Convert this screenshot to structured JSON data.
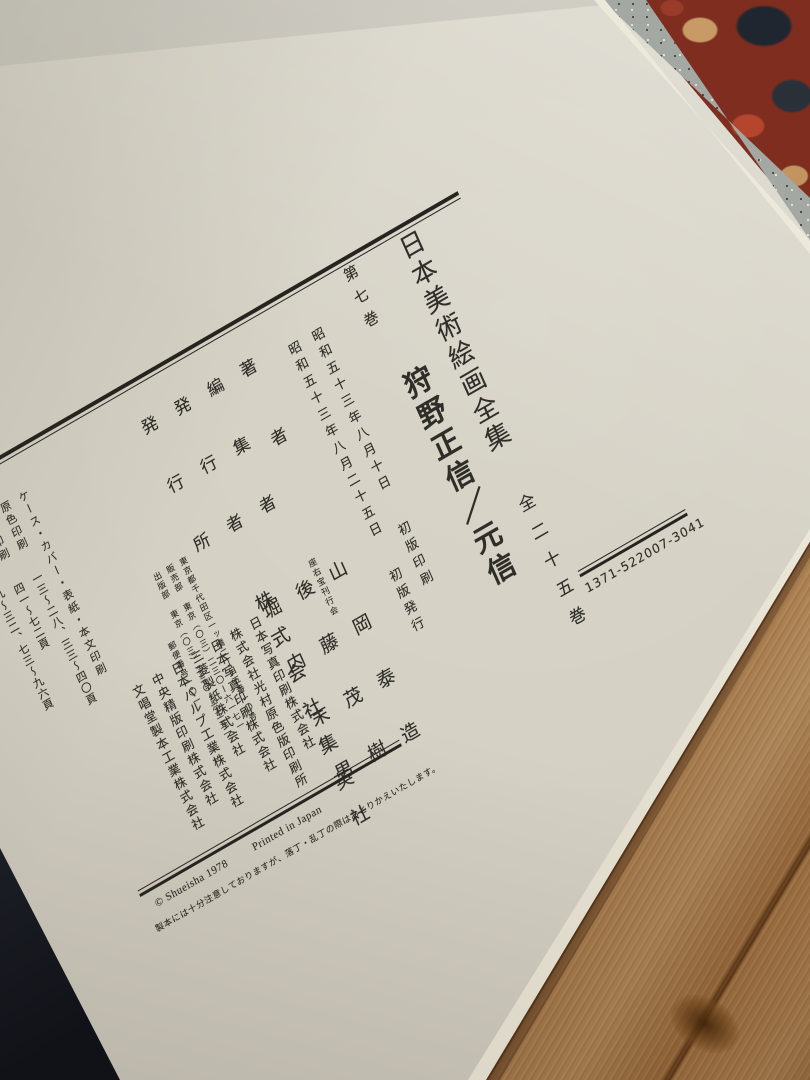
{
  "colophon": {
    "series_title": "日本美術絵画全集",
    "series_subtitle": "全二十五巻",
    "volume_label": "第七巻",
    "volume_title": "狩野正信／元信",
    "print_date": "昭和五十三年八月十日",
    "print_date_note": "初版印刷",
    "issue_date": "昭和五十三年八月二十五日",
    "issue_date_note": "初版発行",
    "credits": [
      {
        "label": "著者",
        "name": "山岡泰造"
      },
      {
        "label": "編集者",
        "name": "後藤茂樹",
        "affiliation": "座右宝刊行会"
      },
      {
        "label": "発行者",
        "name": "堀内末男"
      },
      {
        "label": "発行所",
        "name": "株式会社集英社"
      }
    ],
    "address_lines": [
      "東京都千代田区一ッ橋二丁目五番一〇号",
      "販売部 東京（〇三）二三〇ー六一七一",
      "出版部 東京（〇三）二三〇ー六三五一",
      "郵便番号一〇一"
    ],
    "production": [
      {
        "label": "ケース・カバー・表紙・本文印刷",
        "pages": ""
      },
      {
        "label": "原色印刷",
        "pages": "一三〜二八、三三〜四〇頁"
      },
      {
        "label": "単色印刷",
        "pages": "四一〜七二頁"
      },
      {
        "label": "",
        "pages": "二九〜三二、七三〜九六頁"
      },
      {
        "label": "用紙",
        "pages": ""
      },
      {
        "label": "製本",
        "pages": ""
      }
    ],
    "companies": [
      "日本写真印刷株式会社",
      "株式会社光村原色版印刷所",
      "日本写真印刷株式会社",
      "三菱製紙株式会社",
      "日本パルプ工業株式会社",
      "中央精版印刷株式会社",
      "文唱堂製本工業株式会社"
    ],
    "copyright": "© Shueisha 1978",
    "printed_in": "Printed in Japan",
    "note": "製本には十分注意しておりますが、落丁・乱丁の際はおとりかえいたします。",
    "code": "1371-522007-3041"
  },
  "colors": {
    "paper": "#d4d0c3",
    "ink": "#2f2d28",
    "wood": "#a87a48",
    "slipcase_red": "#7e2d1f"
  }
}
